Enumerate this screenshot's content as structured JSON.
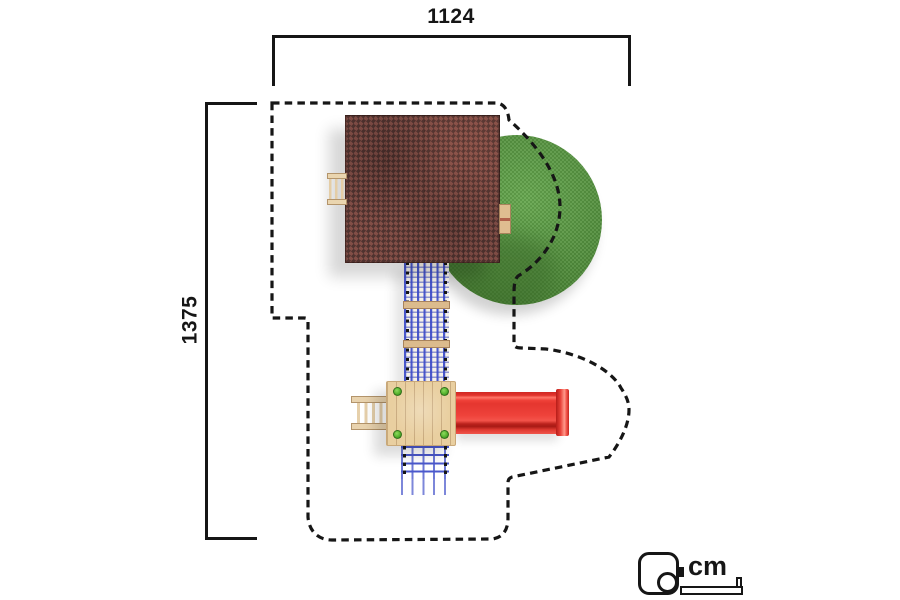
{
  "dimensions": {
    "width": {
      "value": "1124"
    },
    "height": {
      "value": "1375"
    }
  },
  "unit": {
    "label": "cm",
    "icon": "measuring-tape-icon"
  },
  "components": [
    "safety-zone-boundary",
    "playhouse-roof",
    "grass-mound",
    "climbing-net-upper",
    "climbing-net-lower",
    "platform",
    "slide",
    "access-ladder",
    "roof-handrail",
    "roof-step"
  ],
  "colors": {
    "ink": "#161616",
    "roof-base": "#694540",
    "grass": "#559040",
    "grass-dark": "#3c6c2b",
    "net-blue": "#4a58cc",
    "wood": "#e9cfa0",
    "wood-dark": "#c9a878",
    "slide-red": "#ee423a",
    "slide-red-dark": "#bb221c",
    "screw-green": "#55b32e"
  }
}
